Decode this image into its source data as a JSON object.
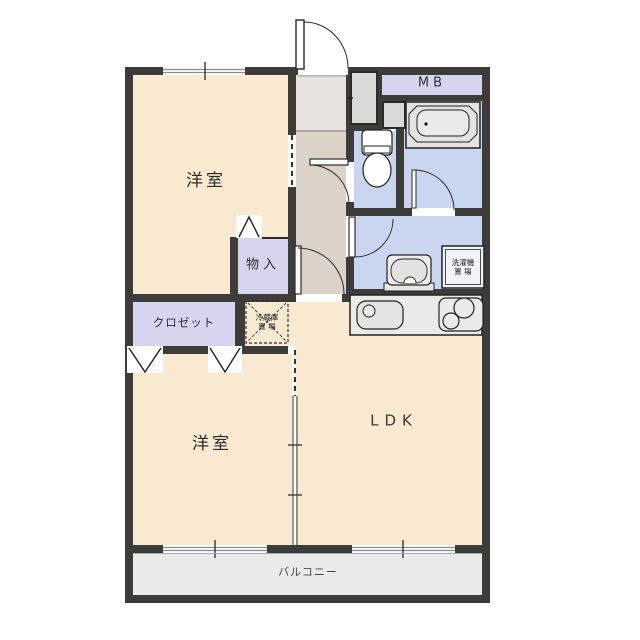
{
  "title": "apartment floor plan",
  "rooms": {
    "bedroom_top": {
      "label": "洋室"
    },
    "bedroom_bottom": {
      "label": "洋室"
    },
    "ldk": {
      "label": "LDK"
    },
    "storage": {
      "label": "物入"
    },
    "closet": {
      "label": "クロゼット"
    },
    "meter_box": {
      "label": "MB"
    },
    "balcony": {
      "label": "バルコニー"
    },
    "fridge_space": {
      "label_line1": "冷蔵庫",
      "label_line2": "置 場"
    },
    "washer_space": {
      "label_line1": "洗濯機",
      "label_line2": "置 場"
    }
  },
  "colors": {
    "wall": "#3e3b3b",
    "room_floor": "#f8e9d0",
    "wet_area_floor": "#cad6f0",
    "closet_fill": "#d5d5f0",
    "hallway_floor": "#dcd3c8",
    "entry_floor": "#e6e3de",
    "balcony_floor": "#eaeaea"
  }
}
